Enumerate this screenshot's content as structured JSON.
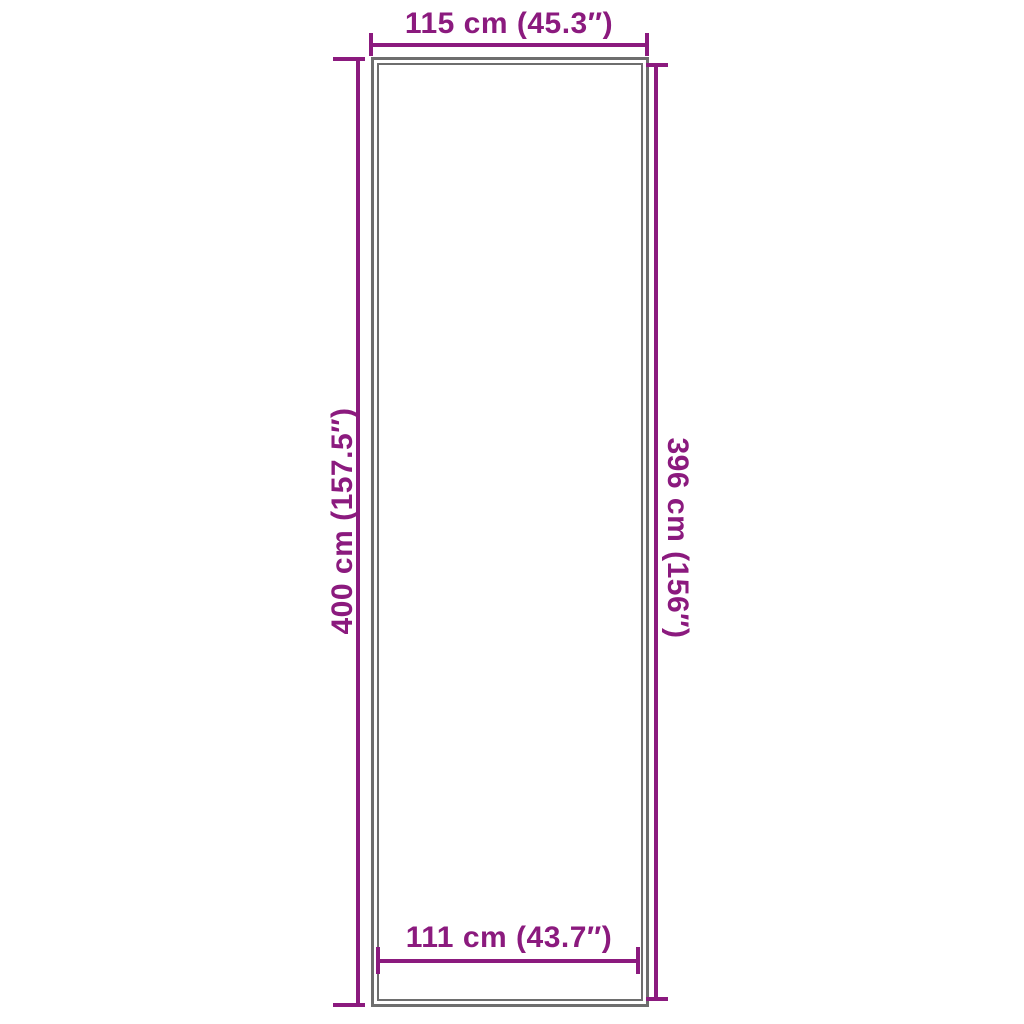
{
  "diagram": {
    "type": "product-dimension-diagram",
    "shape": "tall-rectangle-double-outline",
    "colors": {
      "dimension": "#8B1A7E",
      "outline": "#6E6E6E",
      "background": "#FFFFFF"
    },
    "dimensions": {
      "top": {
        "label": "115 cm (45.3″)",
        "value_cm": 115,
        "value_in": 45.3,
        "measures": "outer width"
      },
      "left": {
        "label": "400 cm (157.5″)",
        "value_cm": 400,
        "value_in": 157.5,
        "measures": "outer height"
      },
      "right": {
        "label": "396 cm (156″)",
        "value_cm": 396,
        "value_in": 156,
        "measures": "inner height"
      },
      "bottom": {
        "label": "111 cm (43.7″)",
        "value_cm": 111,
        "value_in": 43.7,
        "measures": "inner width"
      }
    }
  }
}
